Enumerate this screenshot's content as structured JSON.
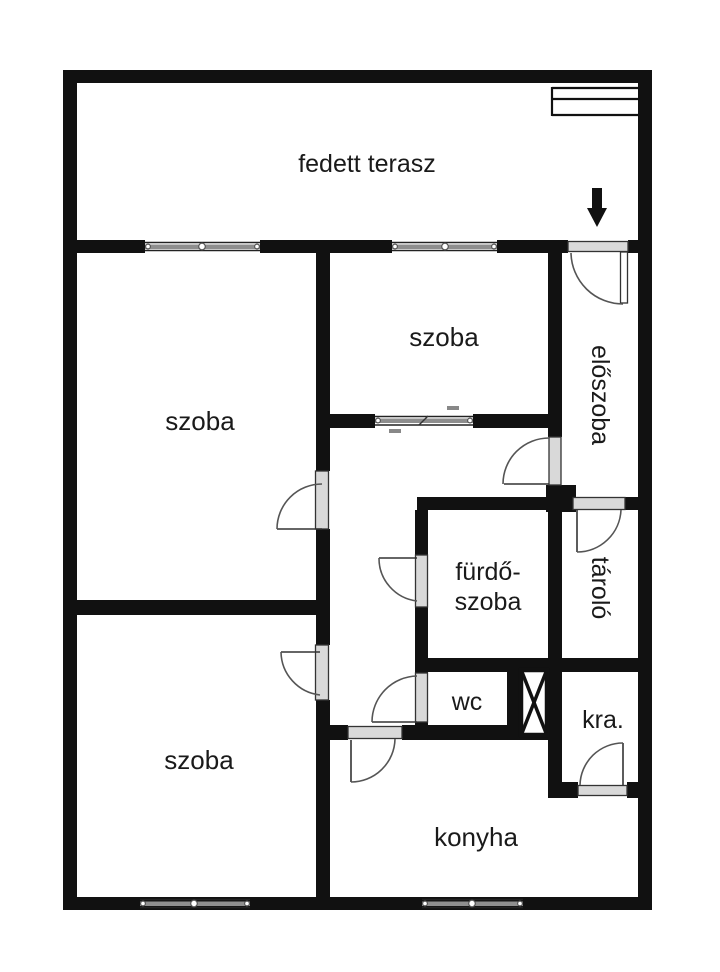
{
  "plan": {
    "background_color": "#ffffff",
    "wall_color": "#111111",
    "rooms": [
      {
        "id": "terrace",
        "label": "fedett terasz"
      },
      {
        "id": "room-top-left",
        "label": "szoba"
      },
      {
        "id": "room-top-middle",
        "label": "szoba"
      },
      {
        "id": "entry-hall",
        "label": "előszoba"
      },
      {
        "id": "storage",
        "label": "tároló"
      },
      {
        "id": "bathroom",
        "label_line1": "fürdő-",
        "label_line2": "szoba"
      },
      {
        "id": "wc",
        "label": "wc"
      },
      {
        "id": "pantry",
        "label": "kra."
      },
      {
        "id": "kitchen",
        "label": "konyha"
      },
      {
        "id": "room-bottom-left",
        "label": "szoba"
      }
    ]
  }
}
